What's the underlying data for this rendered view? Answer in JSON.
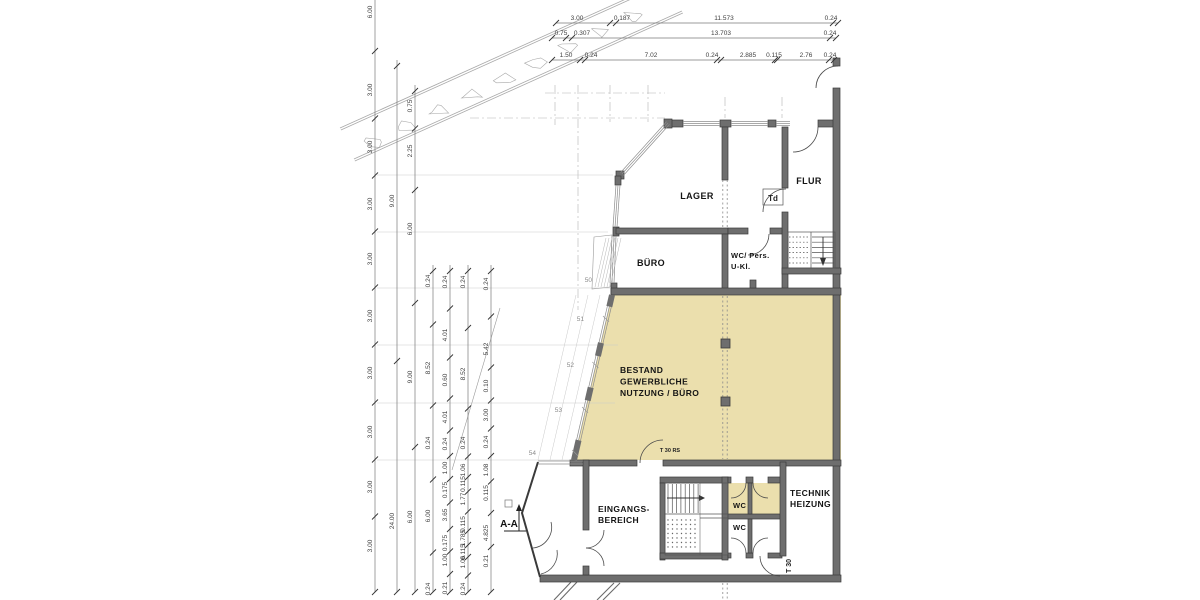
{
  "colors": {
    "background": "#ffffff",
    "area_fill": "#ebdfad",
    "wall_fill": "#6e6e6e",
    "wall_edge": "#3a3a3a",
    "thin_line": "#555555",
    "window_line": "#8c8c8c",
    "dim_line": "#7a7a7a",
    "dim_text": "#3f3f3f",
    "label_text": "#141414",
    "light_line": "#c9c9c9",
    "dash_line": "#b3b3b3",
    "stone_line": "#a9a9a9",
    "point_text": "#8a8a8a"
  },
  "plan": {
    "room_labels": [
      {
        "id": "lager",
        "lines": [
          "LAGER"
        ],
        "x": 697,
        "y": 199,
        "size": 9,
        "anchor": "middle"
      },
      {
        "id": "flur",
        "lines": [
          "FLUR"
        ],
        "x": 809,
        "y": 184,
        "size": 9,
        "anchor": "middle"
      },
      {
        "id": "buero",
        "lines": [
          "BÜRO"
        ],
        "x": 651,
        "y": 266,
        "size": 9,
        "anchor": "middle"
      },
      {
        "id": "wc-pers",
        "lines": [
          "WC/ Pers.",
          "U-Kl."
        ],
        "x": 731,
        "y": 258,
        "size": 7.5,
        "anchor": "start",
        "lh": 11
      },
      {
        "id": "bestand",
        "lines": [
          "BESTAND",
          "GEWERBLICHE",
          "NUTZUNG / BÜRO"
        ],
        "x": 620,
        "y": 373,
        "size": 8.5,
        "anchor": "start",
        "lh": 11.5
      },
      {
        "id": "eingangsbereich",
        "lines": [
          "EINGANGS-",
          "BEREICH"
        ],
        "x": 598,
        "y": 512,
        "size": 8.5,
        "anchor": "start",
        "lh": 11
      },
      {
        "id": "technik-heizung",
        "lines": [
          "TECHNIK",
          "HEIZUNG"
        ],
        "x": 790,
        "y": 496,
        "size": 8.5,
        "anchor": "start",
        "lh": 11
      },
      {
        "id": "wc-top",
        "lines": [
          "WC"
        ],
        "x": 733,
        "y": 508,
        "size": 7.5,
        "anchor": "start"
      },
      {
        "id": "wc-bottom",
        "lines": [
          "WC"
        ],
        "x": 733,
        "y": 530,
        "size": 7.5,
        "anchor": "start"
      }
    ],
    "door_labels": [
      {
        "id": "td",
        "text": "Td",
        "x": 773,
        "y": 201,
        "size": 8,
        "box": [
          763,
          189,
          20,
          16
        ]
      },
      {
        "id": "t30rs",
        "text": "T 30 RS",
        "x": 670,
        "y": 452,
        "size": 5.5
      },
      {
        "id": "t30",
        "text": "T 30",
        "x": 791,
        "y": 566,
        "size": 7,
        "rotate": -90
      }
    ],
    "facade_points": [
      {
        "t": "50",
        "x": 592,
        "y": 282
      },
      {
        "t": "51",
        "x": 584,
        "y": 321
      },
      {
        "t": "52",
        "x": 574,
        "y": 367
      },
      {
        "t": "53",
        "x": 562,
        "y": 412
      },
      {
        "t": "54",
        "x": 536,
        "y": 455
      }
    ],
    "section_marker": {
      "text": "A-A",
      "x": 509,
      "y": 527
    }
  },
  "dimensions": {
    "top_rows": [
      {
        "y": 23,
        "x1": 556,
        "x2": 838,
        "labels": [
          {
            "t": "3.00",
            "x": 577
          },
          {
            "t": "0.187",
            "x": 622
          },
          {
            "t": "11.573",
            "x": 724
          },
          {
            "t": "0.24",
            "x": 831
          }
        ]
      },
      {
        "y": 38,
        "x1": 552,
        "x2": 836,
        "labels": [
          {
            "t": "0.75",
            "x": 561
          },
          {
            "t": "0.307",
            "x": 582
          },
          {
            "t": "13.703",
            "x": 721
          },
          {
            "t": "0.24",
            "x": 830
          }
        ]
      },
      {
        "y": 60,
        "x1": 552,
        "x2": 834,
        "labels": [
          {
            "t": "1.50",
            "x": 566
          },
          {
            "t": "0.24",
            "x": 591
          },
          {
            "t": "7.02",
            "x": 651
          },
          {
            "t": "0.24",
            "x": 712
          },
          {
            "t": "2.885",
            "x": 748
          },
          {
            "t": "0.115",
            "x": 774
          },
          {
            "t": "2.76",
            "x": 806
          },
          {
            "t": "0.24",
            "x": 830
          }
        ]
      }
    ],
    "left_cols": [
      {
        "x": 375,
        "y1": 0,
        "y2": 592,
        "labels": [
          {
            "t": "6.00",
            "y": 12
          },
          {
            "t": "3.00",
            "y": 90
          },
          {
            "t": "3.00",
            "y": 147
          },
          {
            "t": "3.00",
            "y": 204
          },
          {
            "t": "3.00",
            "y": 259
          },
          {
            "t": "3.00",
            "y": 316
          },
          {
            "t": "3.00",
            "y": 373
          },
          {
            "t": "3.00",
            "y": 432
          },
          {
            "t": "3.00",
            "y": 487
          },
          {
            "t": "3.00",
            "y": 546
          }
        ]
      },
      {
        "x": 397,
        "y1": 60,
        "y2": 592,
        "labels": [
          {
            "t": "9.00",
            "y": 201
          },
          {
            "t": "24.00",
            "y": 521
          }
        ]
      },
      {
        "x": 415,
        "y1": 85,
        "y2": 592,
        "labels": [
          {
            "t": "0.75",
            "y": 106
          },
          {
            "t": "2.25",
            "y": 151
          },
          {
            "t": "6.00",
            "y": 229
          },
          {
            "t": "9.00",
            "y": 377
          },
          {
            "t": "6.00",
            "y": 517
          }
        ]
      },
      {
        "x": 433,
        "y1": 265,
        "y2": 592,
        "labels": [
          {
            "t": "0.24",
            "y": 281
          },
          {
            "t": "8.52",
            "y": 368
          },
          {
            "t": "0.24",
            "y": 443
          },
          {
            "t": "6.00",
            "y": 516
          },
          {
            "t": "0.24",
            "y": 589
          }
        ]
      },
      {
        "x": 450,
        "y1": 265,
        "y2": 592,
        "labels": [
          {
            "t": "0.24",
            "y": 282
          },
          {
            "t": "4.01",
            "y": 335
          },
          {
            "t": "0.60",
            "y": 380
          },
          {
            "t": "4.01",
            "y": 417
          },
          {
            "t": "0.24",
            "y": 444
          },
          {
            "t": "1.00",
            "y": 468
          },
          {
            "t": "0.175",
            "y": 490
          },
          {
            "t": "3.65",
            "y": 515
          },
          {
            "t": "0.175",
            "y": 543
          },
          {
            "t": "1.00",
            "y": 560
          },
          {
            "t": "0.21",
            "y": 588
          }
        ]
      },
      {
        "x": 468,
        "y1": 265,
        "y2": 592,
        "labels": [
          {
            "t": "0.24",
            "y": 282
          },
          {
            "t": "8.52",
            "y": 374
          },
          {
            "t": "0.24",
            "y": 443
          },
          {
            "t": "1.06",
            "y": 470
          },
          {
            "t": "0.115",
            "y": 484
          },
          {
            "t": "1.77",
            "y": 499
          },
          {
            "t": "0.115",
            "y": 524
          },
          {
            "t": "1.785",
            "y": 538
          },
          {
            "t": "0.115",
            "y": 552
          },
          {
            "t": "1.06",
            "y": 562
          },
          {
            "t": "0.24",
            "y": 589
          }
        ]
      },
      {
        "x": 491,
        "y1": 265,
        "y2": 592,
        "labels": [
          {
            "t": "0.24",
            "y": 284
          },
          {
            "t": "5.42",
            "y": 349
          },
          {
            "t": "0.10",
            "y": 386
          },
          {
            "t": "3.00",
            "y": 415
          },
          {
            "t": "0.24",
            "y": 442
          },
          {
            "t": "1.08",
            "y": 470
          },
          {
            "t": "0.115",
            "y": 493
          },
          {
            "t": "4.825",
            "y": 533
          },
          {
            "t": "0.21",
            "y": 561
          }
        ]
      }
    ]
  }
}
